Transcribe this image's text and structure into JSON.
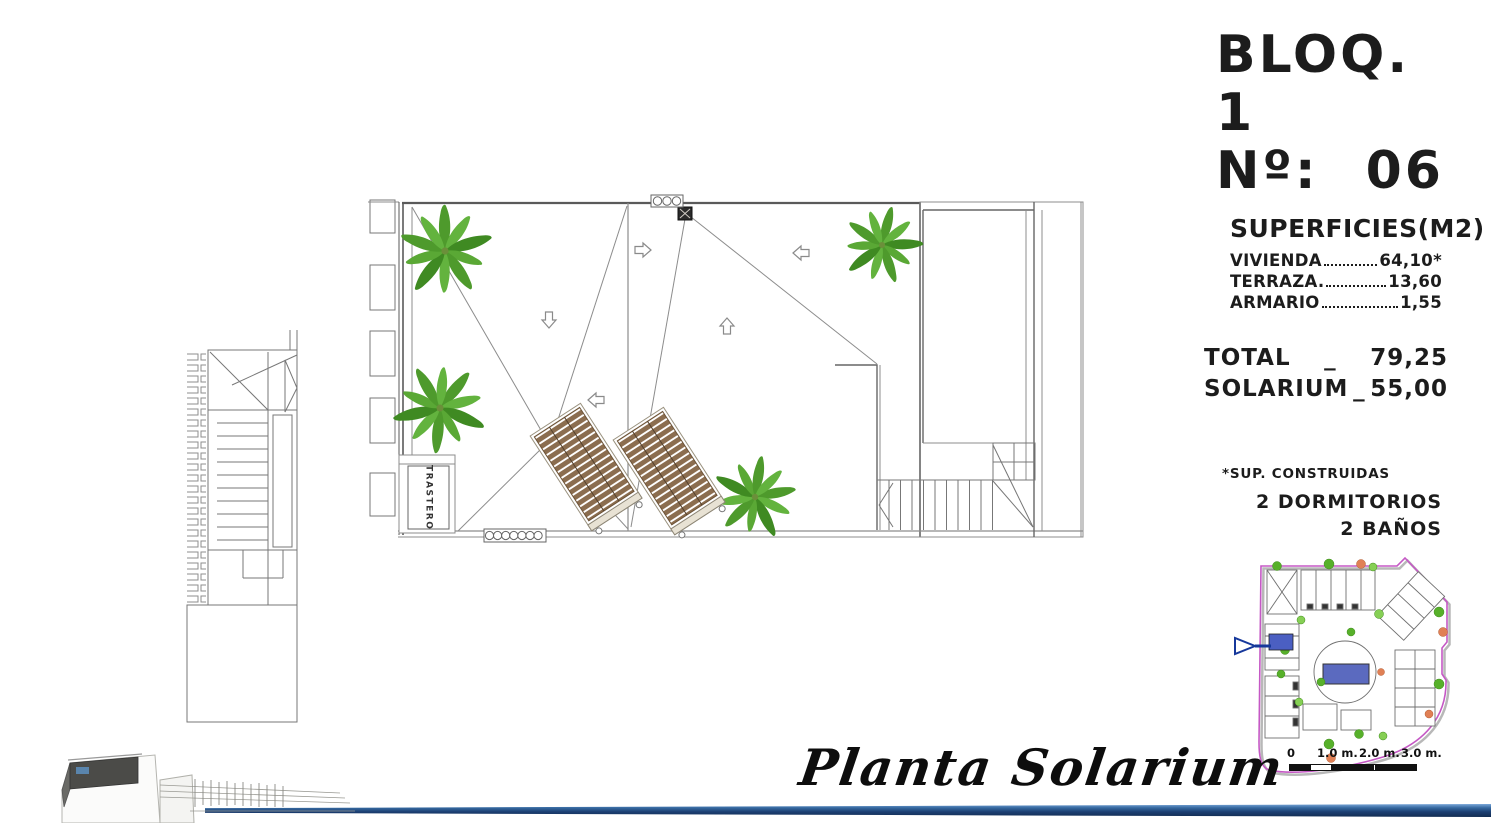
{
  "header": {
    "block": "BLOQ. 1",
    "number_label": "Nº:",
    "number_value": "06"
  },
  "surfaces": {
    "title": "SUPERFICIES(M2)",
    "rows": [
      {
        "label": "VIVIENDA",
        "value": "64,10*"
      },
      {
        "label": "TERRAZA.",
        "value": "13,60"
      },
      {
        "label": "ARMARIO",
        "value": "1,55"
      }
    ]
  },
  "totals": {
    "rows": [
      {
        "label": "TOTAL",
        "sep": "_",
        "value": "79,25"
      },
      {
        "label": "SOLARIUM",
        "sep": "_",
        "value": "55,00"
      }
    ]
  },
  "notes": {
    "built_note": "*SUP. CONSTRUIDAS",
    "bedrooms": "2 DORMITORIOS",
    "bathrooms": "2 BAÑOS"
  },
  "plan": {
    "storage_label": "TRASTERO",
    "title": "Planta Solarium"
  },
  "minimap": {
    "scale_labels": [
      "0",
      "1.0 m.",
      "2.0 m.",
      "3.0 m."
    ]
  },
  "colors": {
    "palm_green": "#4e9a2c",
    "lounger_brown": "#8b6d4f",
    "pool_blue": "#5b6abf",
    "unit_blue": "#4b5fc2",
    "boundary_magenta": "#c558c5",
    "footer_navy": "#1c3f72"
  }
}
